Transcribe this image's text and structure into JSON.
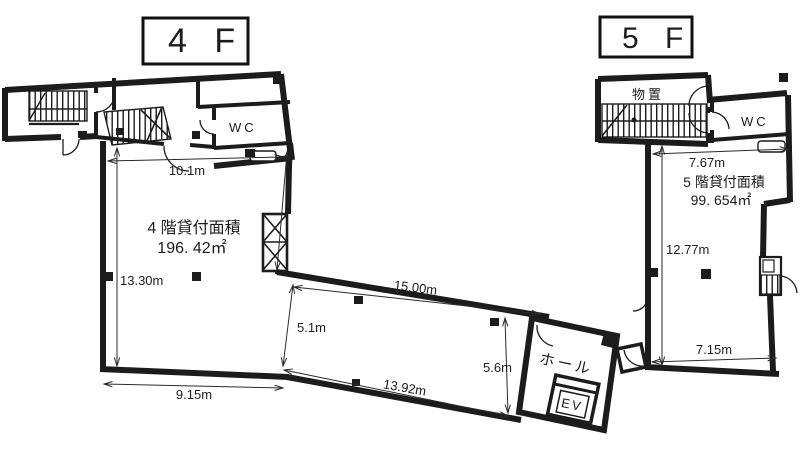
{
  "floor4": {
    "floor_label": "4 F",
    "area_caption": "4 階貸付面積",
    "area_value": "196. 42㎡",
    "wc_label": "WC",
    "hall_label": "ホール",
    "elevator_label": "EV",
    "dim_top": "10.1m",
    "dim_left": "13.30m",
    "dim_bottom": "9.15m",
    "dim_corridor_top": "15.00m",
    "dim_corridor_bottom": "13.92m",
    "dim_corridor_left": "5.1m",
    "dim_corridor_right": "5.6m"
  },
  "floor5": {
    "floor_label": "5 F",
    "storage_label": "物置",
    "wc_label": "WC",
    "area_caption": "5 階貸付面積",
    "area_value": "99. 654㎡",
    "dim_top": "7.67m",
    "dim_left": "12.77m",
    "dim_bottom": "7.15m"
  },
  "colors": {
    "ink": "#1c1c1c",
    "dim_line": "#2a2a2a",
    "background": "#ffffff"
  }
}
